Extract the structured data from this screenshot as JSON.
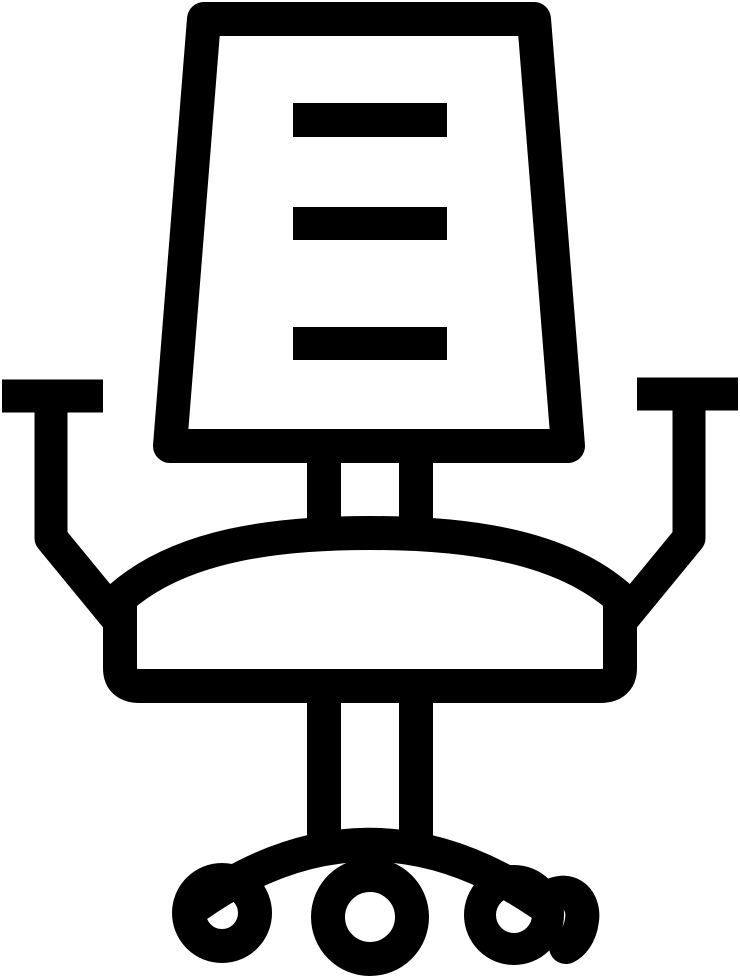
{
  "page": {
    "background_color": "#ffffff"
  },
  "icon": {
    "title": "Office chair icon",
    "style": "solid black outline glyph",
    "color": "#000000",
    "background_color": "#ffffff",
    "slat_count": 3,
    "wheel_count": 3,
    "parts": [
      "backrest-frame",
      "backrest-slat-top",
      "backrest-slat-middle",
      "backrest-slat-bottom",
      "left-armrest",
      "right-armrest",
      "backrest-post-left",
      "backrest-post-right",
      "seat",
      "pedestal-post-left",
      "pedestal-post-right",
      "base-arc",
      "left-wheel",
      "center-wheel",
      "right-wheel"
    ]
  }
}
